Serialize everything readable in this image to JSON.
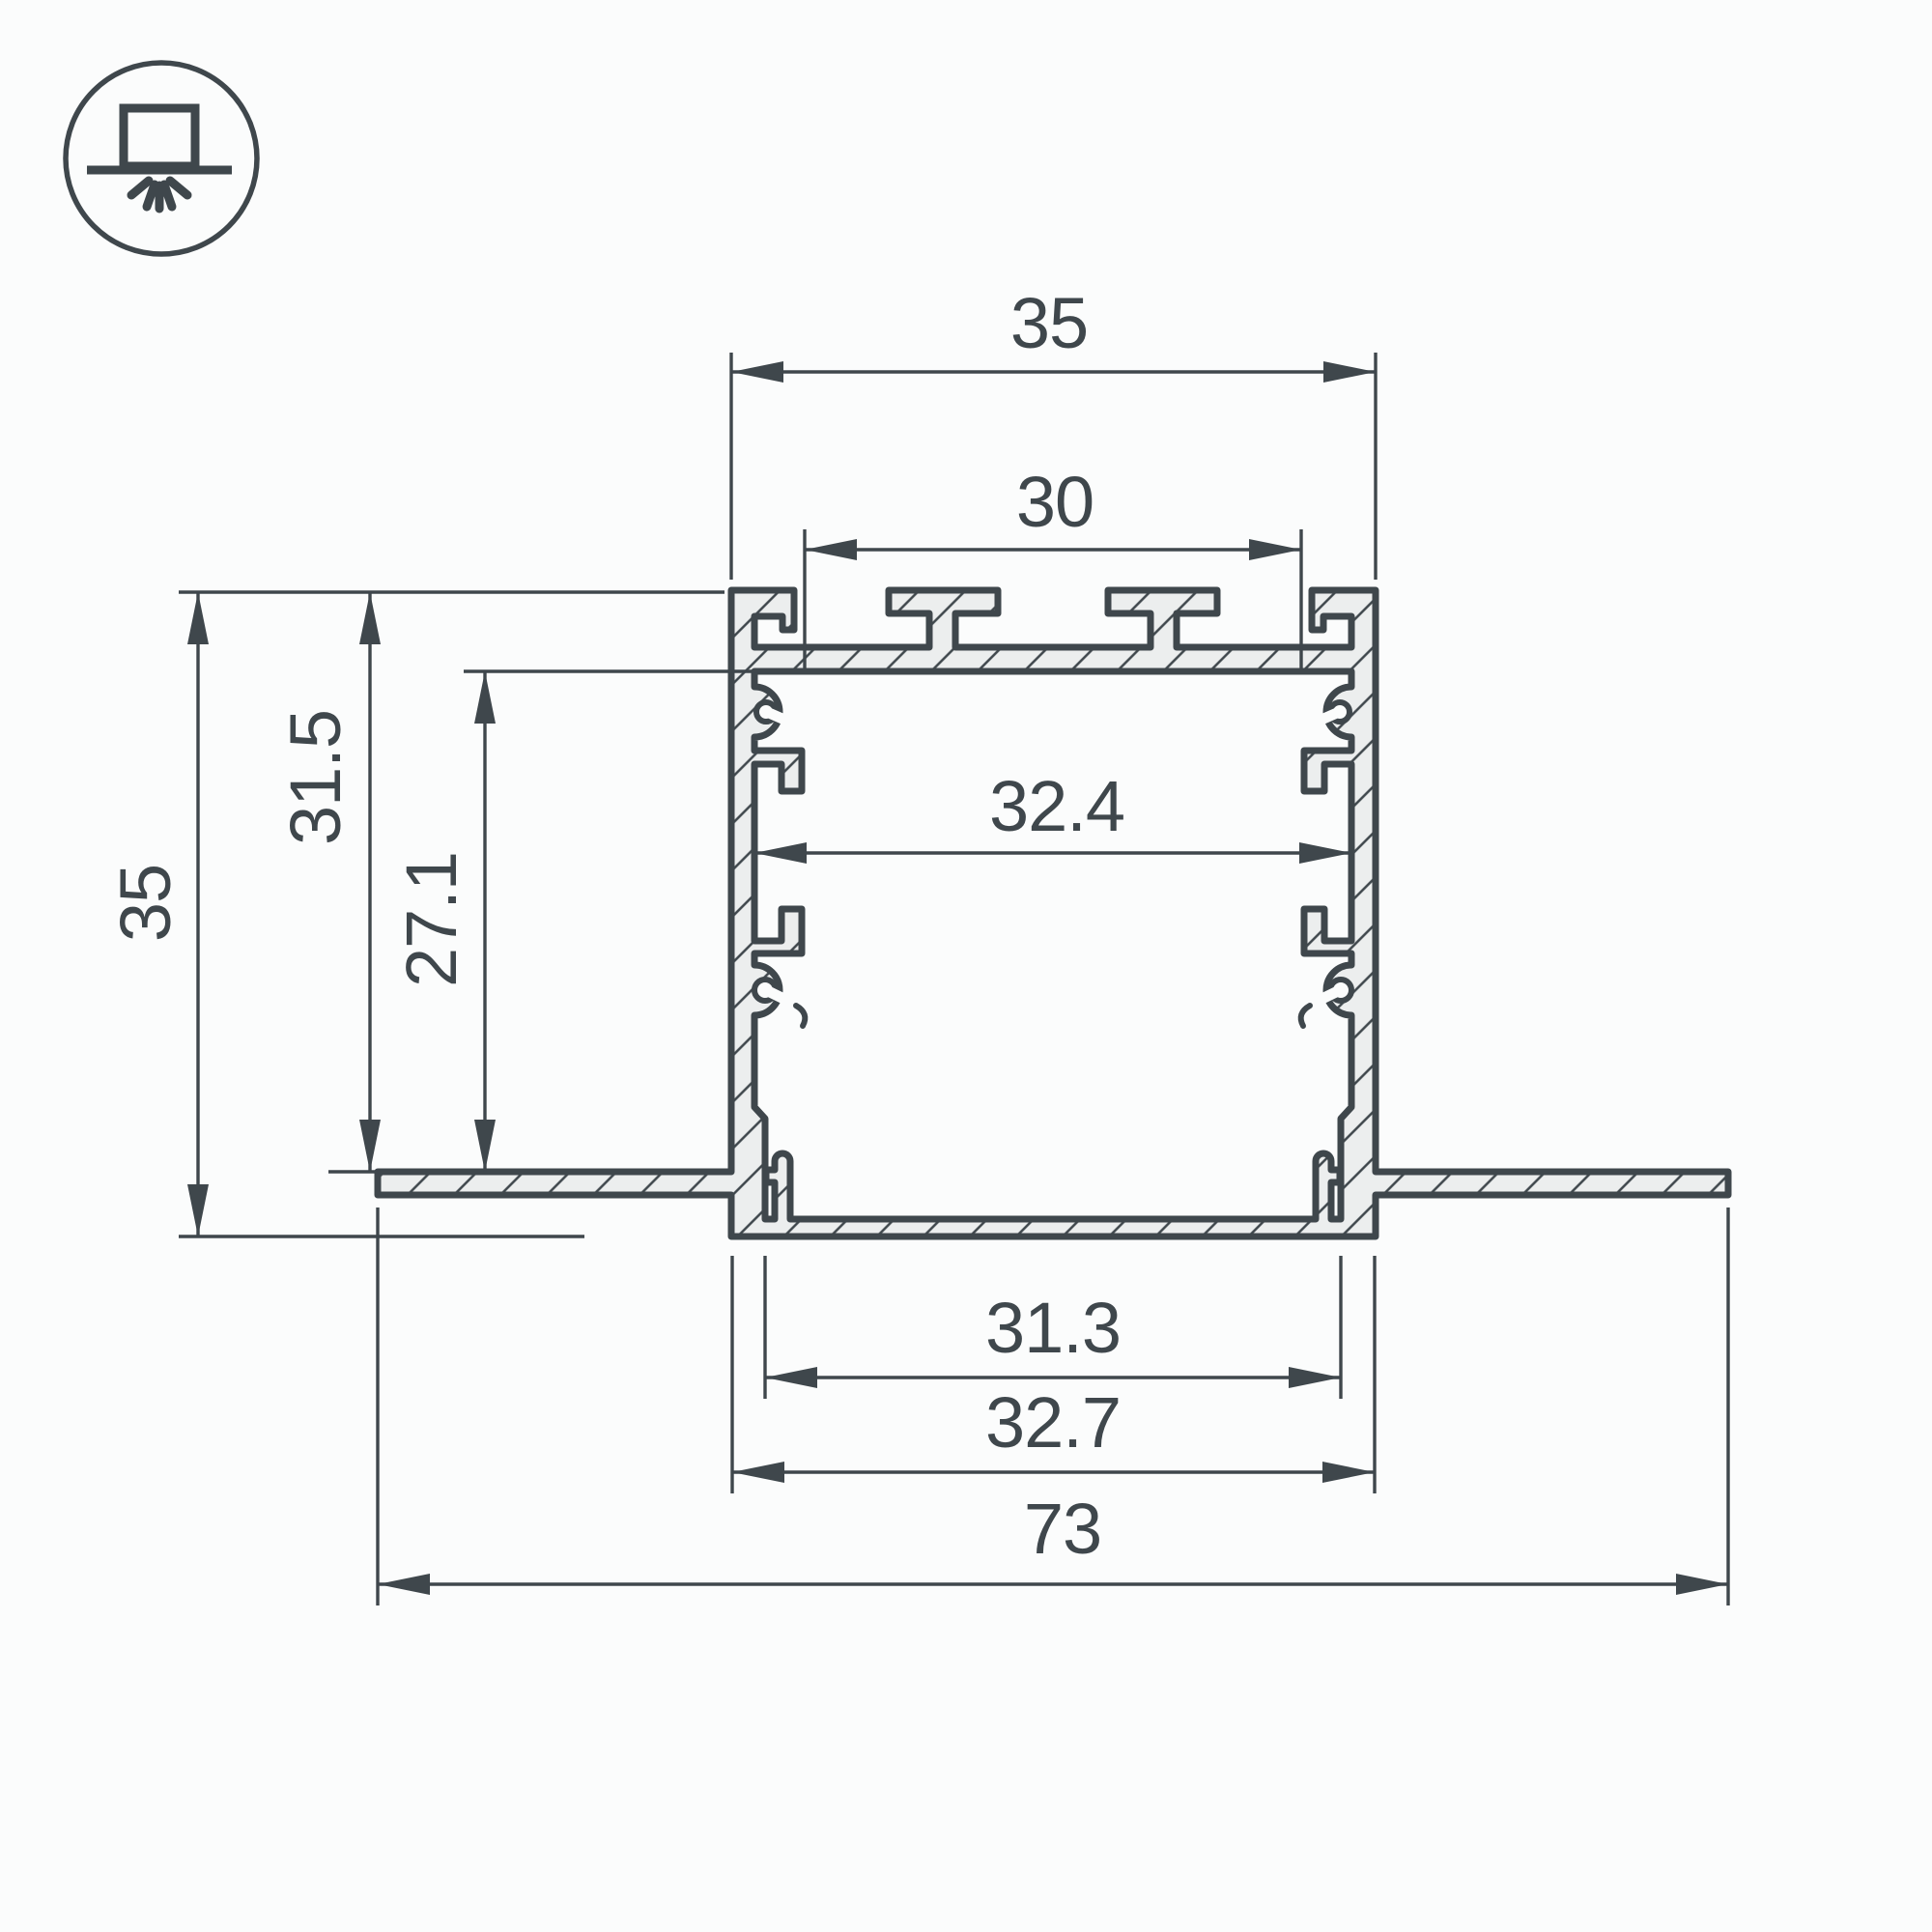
{
  "drawing": {
    "type": "technical-cross-section",
    "subject": "recessed-led-profile",
    "icon": {
      "name": "recessed-mount-icon",
      "meaning": "recessed ceiling mounting"
    },
    "dimensions": {
      "top_width": "35",
      "top_opening": "30",
      "inner_width": "32.4",
      "overall_height": "35",
      "height_to_flange": "31.5",
      "channel_depth": "27.1",
      "bottom_inner_width": "31.3",
      "bottom_outer_width": "32.7",
      "overall_width": "73"
    },
    "colors": {
      "line": "#3f474c",
      "metal_fill": "#eceeee",
      "background": "#fbfcfc"
    }
  }
}
